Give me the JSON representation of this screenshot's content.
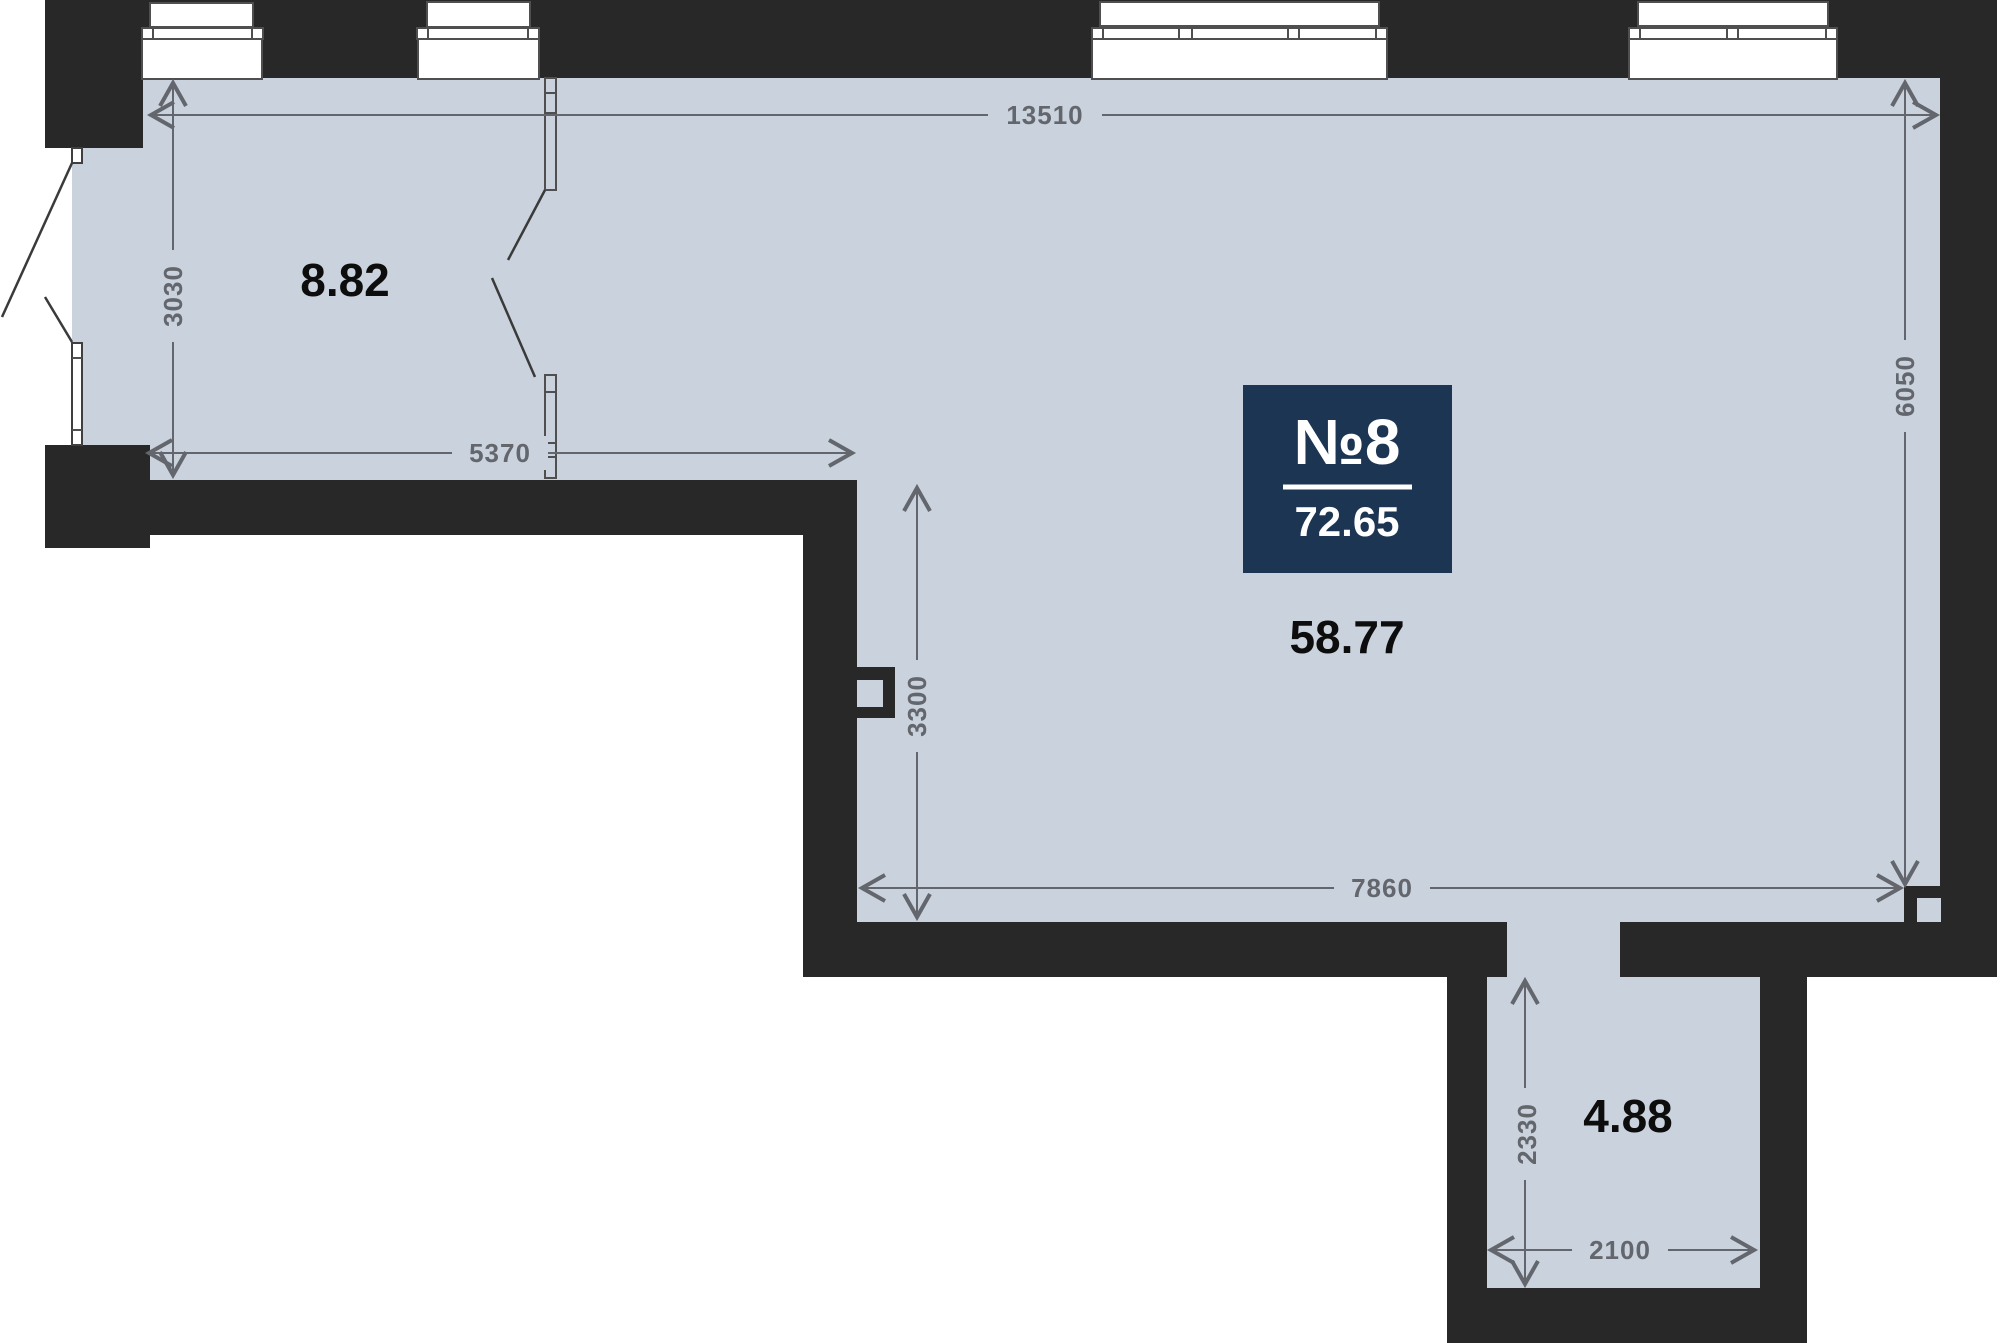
{
  "badge": {
    "unit_number": "№8",
    "total_area": "72.65"
  },
  "rooms": {
    "left_area": "8.82",
    "main_area": "58.77",
    "bottom_area": "4.88"
  },
  "dimensions": {
    "top_width": "13510",
    "left_room_height": "3030",
    "left_room_width": "5370",
    "main_room_notch_height": "3300",
    "right_side_height": "6050",
    "main_room_bottom_width": "7860",
    "corridor_height": "2330",
    "corridor_width": "2100"
  },
  "colors": {
    "floor": "#cad3dd",
    "wall": "#282828",
    "dimension": "#63666c",
    "room_label": "#0d0d0d",
    "badge_bg": "#1c3553",
    "badge_text": "#ffffff",
    "window_frame": "#4f4f4f"
  }
}
